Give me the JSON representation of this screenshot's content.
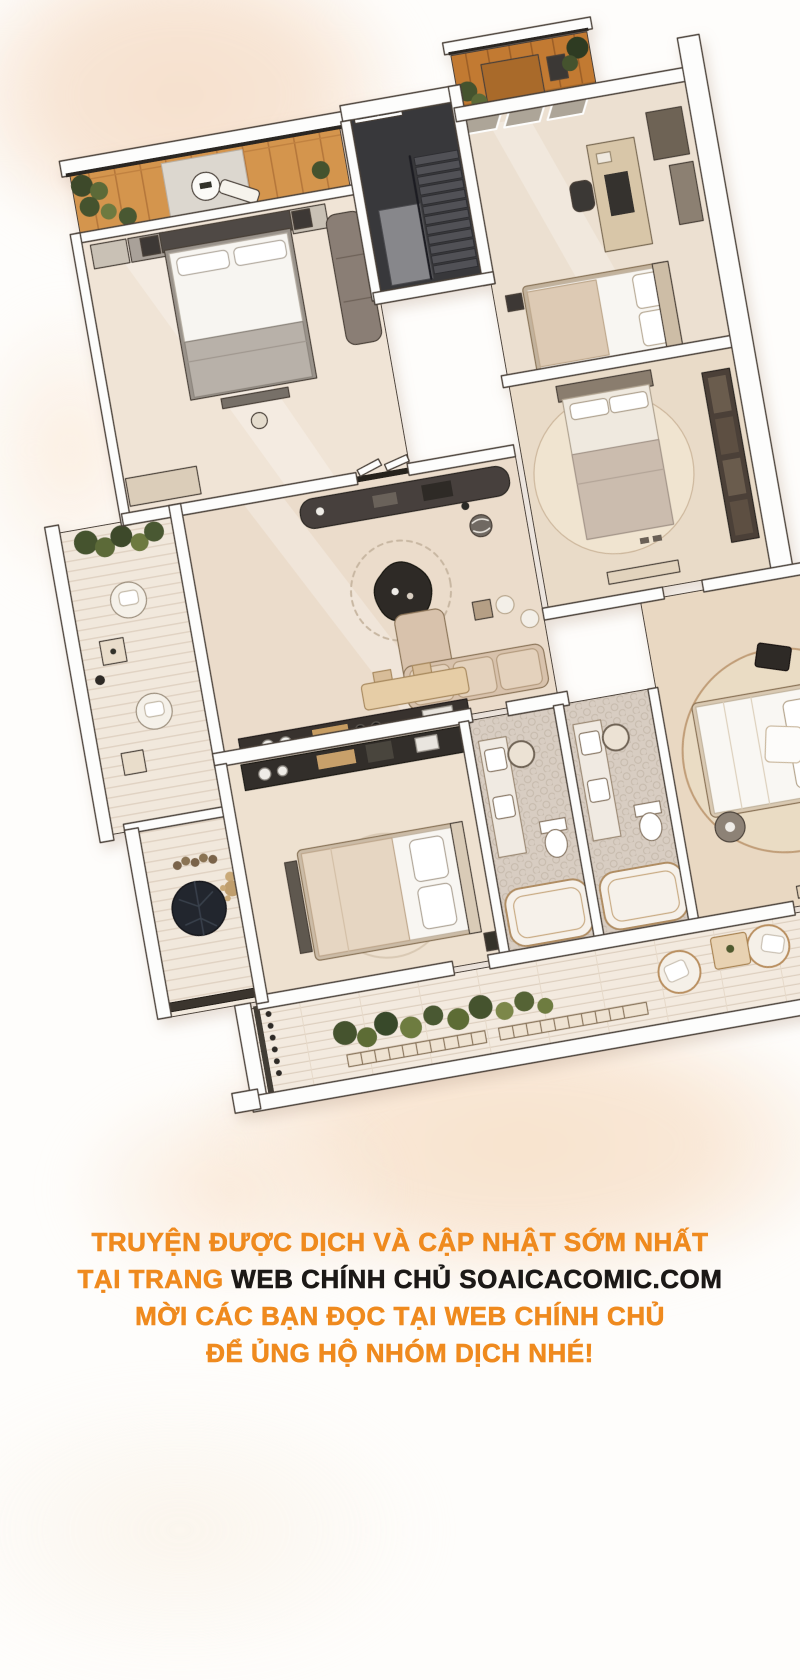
{
  "footer": {
    "line1": "TRUYỆN ĐƯỢC DỊCH VÀ CẬP NHẬT SỚM NHẤT",
    "line2_orange": "TẠI TRANG ",
    "line2_black": "WEB CHÍNH CHỦ SOAICACOMIC.COM",
    "line3": "MỜI CÁC BẠN ĐỌC TẠI WEB CHÍNH CHỦ",
    "line4": "ĐỂ ỦNG HỘ NHÓM DỊCH NHÉ!",
    "accent_color": "#ef8a1e",
    "dark_color": "#1c1917"
  },
  "artwork": {
    "kind": "tilted top-down cutaway floor plan illustration",
    "rotation_deg": -10,
    "rooms": [
      "balcony-top-left",
      "master-bedroom",
      "stairwell",
      "balcony-top-right",
      "study-bedroom",
      "bedroom-right",
      "living-room",
      "balcony-left",
      "bedroom-bottom-left",
      "bathroom-left",
      "bathroom-right",
      "bedroom-bottom-right",
      "corridor-bottom-left",
      "terrace-bottom"
    ],
    "palette": {
      "wood": "#d4954e",
      "wood_dark": "#c27a33",
      "floor_cream": "#f0e4d6",
      "floor_pink": "#ebdccb",
      "wall_fill": "#fdfdfc",
      "outline": "#4a4038",
      "dark_furniture": "#35302c",
      "plant_green": "#4a5830",
      "tile": "#d8cdc2",
      "wash_peach": "#f8e4cf"
    }
  }
}
